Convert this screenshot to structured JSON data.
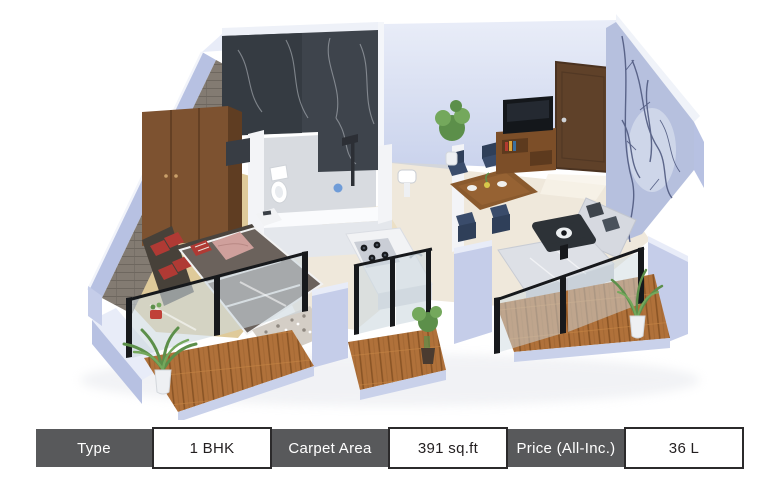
{
  "spec_table": {
    "cells": [
      {
        "label": "Type",
        "value": "1 BHK"
      },
      {
        "label": "Carpet Area",
        "value": "391 sq.ft"
      },
      {
        "label": "Price (All-Inc.)",
        "value": "36 L"
      }
    ]
  },
  "palette": {
    "table_label_bg": "#58595b",
    "table_label_text": "#ffffff",
    "table_value_bg": "#ffffff",
    "table_value_text": "#231f20",
    "table_value_border": "#2b2a2b",
    "wall_face": "#c5cde9",
    "wall_side": "#b7c1e2",
    "wall_top": "#e8ecf8",
    "brick_wall": "#837b72",
    "marble_dark": "#3e444c",
    "marble_darker": "#353b42",
    "back_wall_light": "#dde3f3",
    "wallpaper_blue": "#b6c0de",
    "branch_color": "#49537a",
    "white_wall": "#f3f4f7",
    "bath_floor": "#d8dbe0",
    "cream_floor": "#efe8db",
    "kitchen_floor": "#ece0c6",
    "bedroom_floor": "#dfca9a",
    "wood_plank": "#b0713a",
    "wardrobe_wood": "#7d5230",
    "door_wood": "#5f4129",
    "console_wood": "#7c4e28",
    "table_wood": "#8a5a2e",
    "bed_gray": "#6b625c",
    "headboard_dark": "#4a443e",
    "pillow_red": "#b03a34",
    "blanket_pink": "#cfa09c",
    "sofa_gray": "#d6d9e0",
    "pillow_dark": "#3e444c",
    "chair_navy": "#3a4c6b",
    "glass_tint": "#cdd9e0",
    "frame_black": "#17191c",
    "tv_black": "#14171b",
    "plant_green": "#5c8f4a",
    "plant_light": "#74a85c",
    "pot_white": "#eef0f3",
    "counter_white": "#f2f3f5",
    "cooktop_gray": "#caced6"
  }
}
